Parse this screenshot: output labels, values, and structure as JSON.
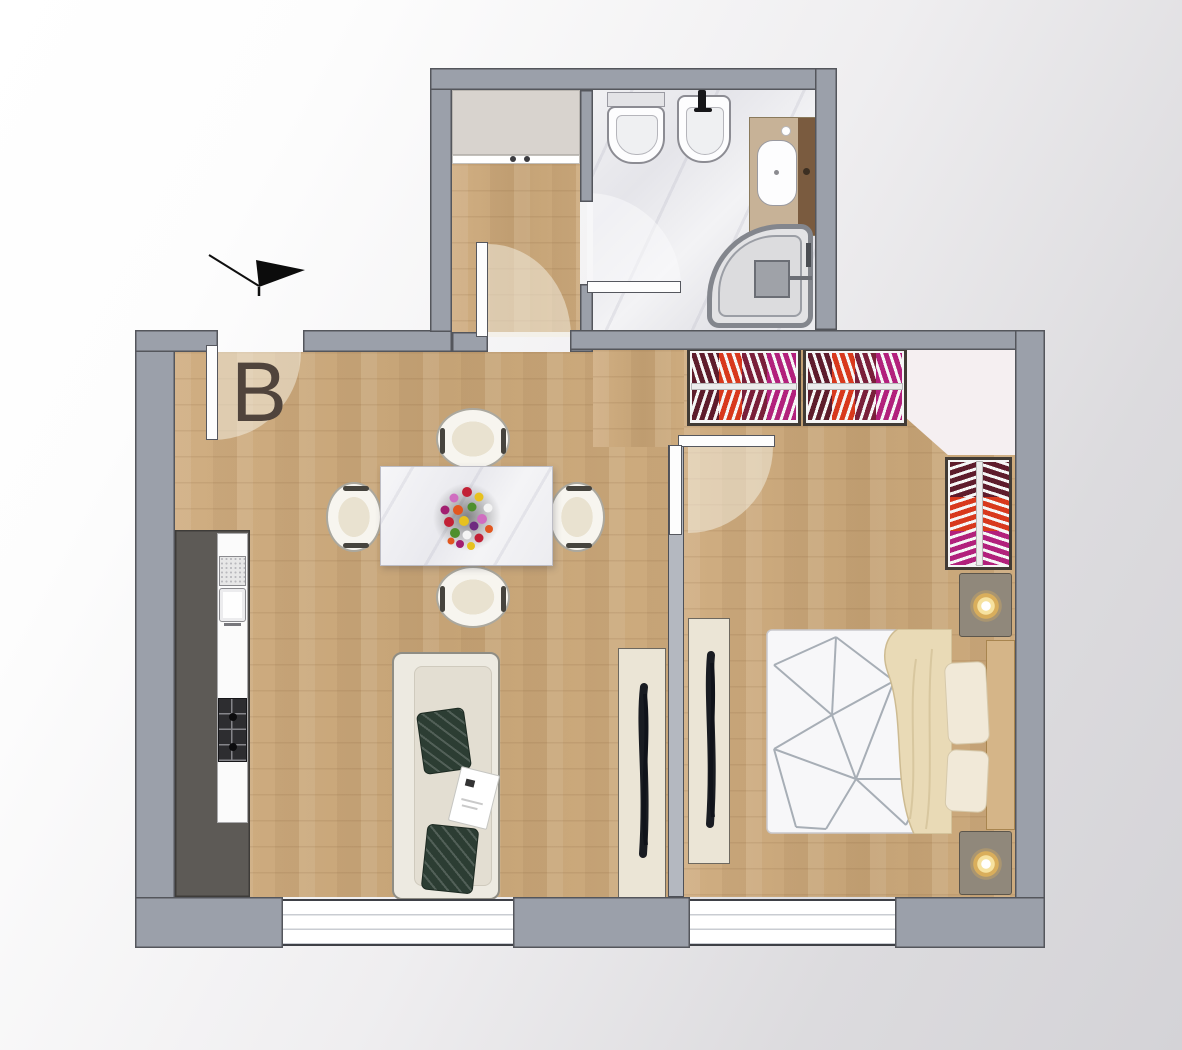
{
  "floorplan": {
    "unit_label": "B",
    "icons": {
      "entrance_arrow": "black-entrance-arrow"
    },
    "window_count": 2,
    "door_count": 4,
    "colors": {
      "wall": "#9ba0aa",
      "wall_outline": "#54565c",
      "interior_partition": "#b4b8c0",
      "wood_floor": "#c9a87c",
      "marble_floor": "#ebebee",
      "kitchen_unit": "#5d5a56",
      "corner_niche": "#f5eff1",
      "wardrobe_clothes": [
        "#5e1c2c",
        "#d8391d",
        "#b2207c"
      ],
      "lamp_glow": "#d9ae5c",
      "sofa_pillow_green": "#2c3d33",
      "label_text": "#50443c"
    }
  }
}
